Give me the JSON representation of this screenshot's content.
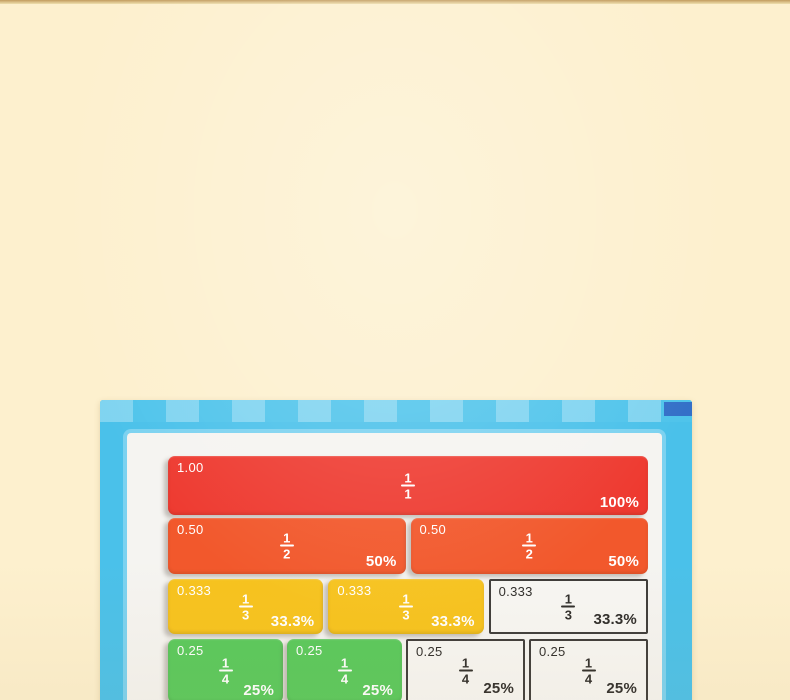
{
  "background": {
    "color": "#FDF0CE",
    "top_strip_color": "#C29B5E"
  },
  "board": {
    "frame_color": "#4AC1EA",
    "checker_light": "#72D2F3",
    "corner_tab_color": "#3470C8",
    "surface_color": "#F5F4F1",
    "colors": {
      "red": "#EE3A30",
      "orange": "#F2582C",
      "yellow": "#F7C31E",
      "green": "#59C95C",
      "printed": "#F7F6F3"
    },
    "rows": [
      {
        "label": "wholes",
        "cells": [
          {
            "kind": "tile",
            "color": "red",
            "decimal": "1.00",
            "numerator": "1",
            "denominator": "1",
            "percent": "100%"
          }
        ]
      },
      {
        "label": "halves",
        "cells": [
          {
            "kind": "tile",
            "color": "orange",
            "decimal": "0.50",
            "numerator": "1",
            "denominator": "2",
            "percent": "50%"
          },
          {
            "kind": "tile",
            "color": "orange",
            "decimal": "0.50",
            "numerator": "1",
            "denominator": "2",
            "percent": "50%"
          }
        ]
      },
      {
        "label": "thirds",
        "cells": [
          {
            "kind": "tile",
            "color": "yellow",
            "decimal": "0.333",
            "numerator": "1",
            "denominator": "3",
            "percent": "33.3%"
          },
          {
            "kind": "tile",
            "color": "yellow",
            "decimal": "0.333",
            "numerator": "1",
            "denominator": "3",
            "percent": "33.3%"
          },
          {
            "kind": "printed",
            "color": "printed",
            "decimal": "0.333",
            "numerator": "1",
            "denominator": "3",
            "percent": "33.3%"
          }
        ]
      },
      {
        "label": "quarters",
        "cells": [
          {
            "kind": "tile",
            "color": "green",
            "decimal": "0.25",
            "numerator": "1",
            "denominator": "4",
            "percent": "25%"
          },
          {
            "kind": "tile",
            "color": "green",
            "decimal": "0.25",
            "numerator": "1",
            "denominator": "4",
            "percent": "25%"
          },
          {
            "kind": "printed",
            "color": "printed",
            "decimal": "0.25",
            "numerator": "1",
            "denominator": "4",
            "percent": "25%"
          },
          {
            "kind": "printed",
            "color": "printed",
            "decimal": "0.25",
            "numerator": "1",
            "denominator": "4",
            "percent": "25%"
          }
        ]
      }
    ]
  }
}
